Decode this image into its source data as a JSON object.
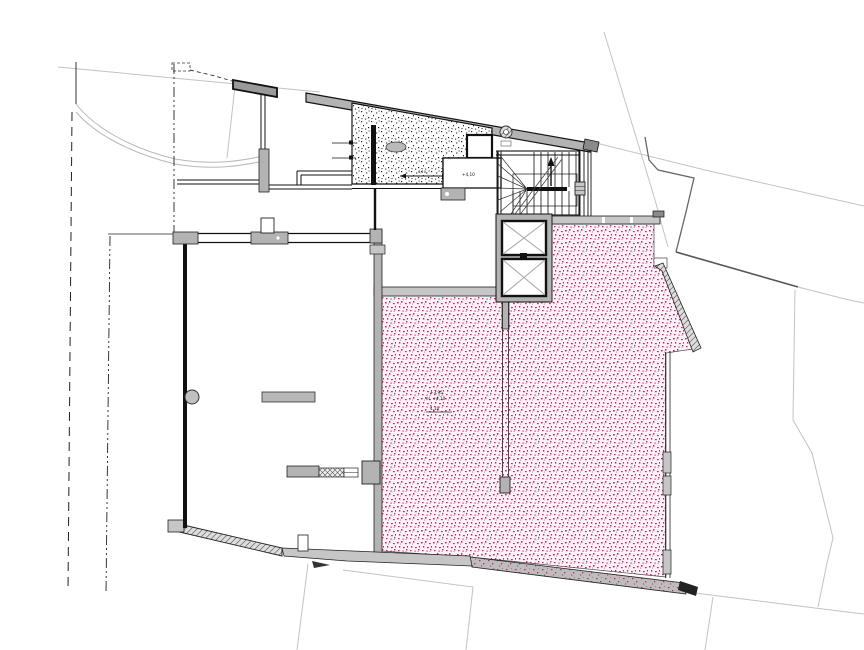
{
  "page": {
    "background": "#ffffff"
  },
  "drawing": {
    "type": "architectural-floor-plan-roof-terrace-level",
    "colors": {
      "pink_dot": "#c2256b",
      "pink_dot_light": "#da7fae",
      "pink_bg": "#fdf3f8",
      "wall_gray": "#b3b3b3",
      "band_gray": "#c6c6c6",
      "dark_block_gray": "#9a9a9a",
      "outline": "#1a1a1a",
      "site_line": "#c3c3c3",
      "boundary_dark": "#666666",
      "stipple_black": "#222222",
      "hatch_bg": "#dedede",
      "hatch_line": "#777777",
      "parapet_bg": "#bdbdbd",
      "elevator_x": "#a8a8a8"
    },
    "labels": {
      "upper_room_elevation": "+4,10",
      "terrace_line1": "+3,95",
      "terrace_line2": "el. +4,10",
      "terrace_line3": "4,10",
      "hatch_dim": "4,10"
    }
  }
}
